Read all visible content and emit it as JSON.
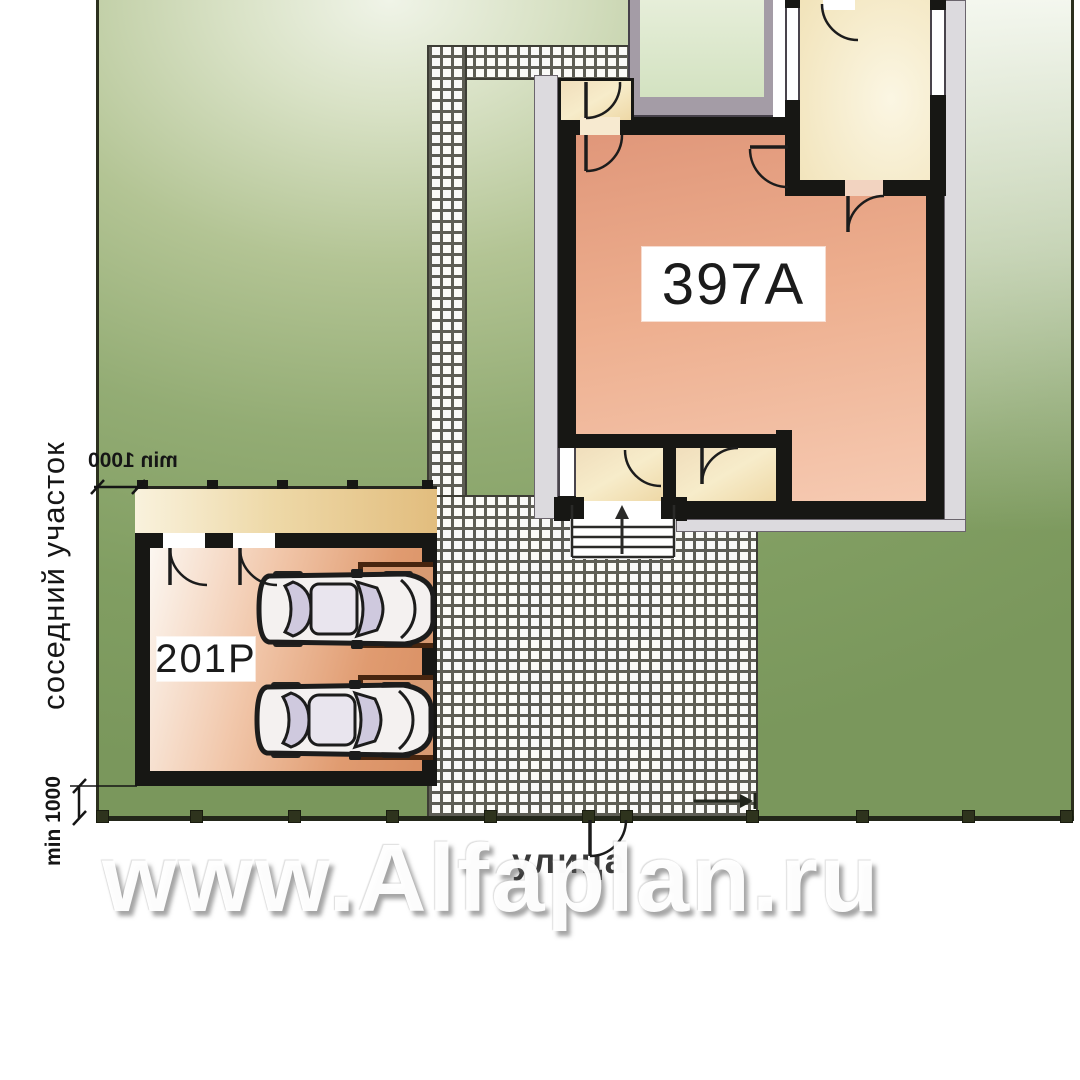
{
  "labels": {
    "house_code": "397A",
    "garage_code": "201P",
    "street": "улица",
    "neighbor_plot": "соседний участок",
    "setback_top": "min 1000",
    "setback_bottom": "min 1000",
    "watermark": "www.Alfaplan.ru"
  },
  "colors": {
    "lawn": "#8aa76b",
    "cobble_grout": "#5d5d54",
    "wall_black": "#171714",
    "house_salmon": "#edae8e",
    "room_cream": "#f3e6c2",
    "terrace_green": "#dde9d0",
    "pergola_tan": "#eed9a8",
    "garage_bay_brown": "#47250f",
    "boundary": "#2c301e"
  }
}
